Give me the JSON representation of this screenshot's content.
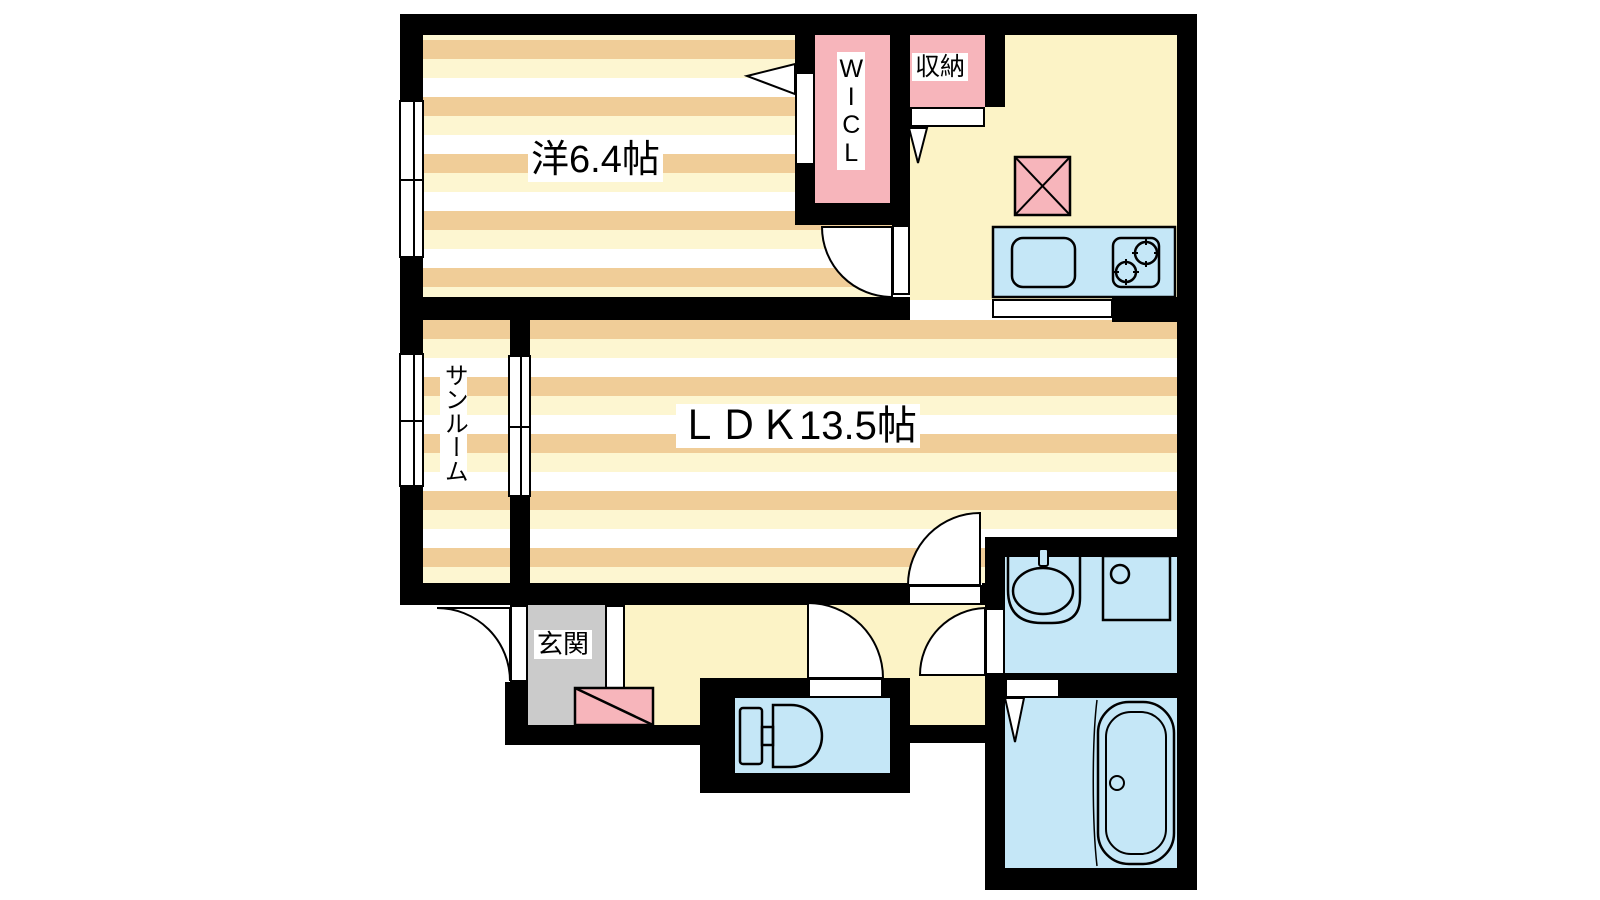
{
  "plan": {
    "type": "apartment-floor-plan",
    "rooms": {
      "bedroom": {
        "label": "洋6.4帖"
      },
      "ldk": {
        "label": "ＬＤＫ13.5帖"
      },
      "wicl": {
        "label": "WICL"
      },
      "storage": {
        "label": "収納"
      },
      "sunroom": {
        "label": "サンルーム"
      },
      "entrance": {
        "label": "玄関"
      }
    },
    "fixtures": [
      "refrigerator-space-icon",
      "kitchen-counter-icon",
      "sink-icon",
      "stove-icon",
      "shoe-cabinet-icon",
      "toilet-icon",
      "washbasin-icon",
      "washing-machine-pan-icon",
      "bathtub-icon",
      "folding-door-icon",
      "hinged-door-icon",
      "sliding-window-icon"
    ],
    "colors": {
      "wall": "#000000",
      "stripe_tan": "#F0CD98",
      "stripe_cream": "#FDF6D1",
      "floor_yellow": "#FCF3C6",
      "closet_pink": "#F7B5BB",
      "fixture_blue": "#C5E7F7",
      "entrance_gray": "#CBCBCB",
      "background": "#FFFFFF"
    }
  }
}
